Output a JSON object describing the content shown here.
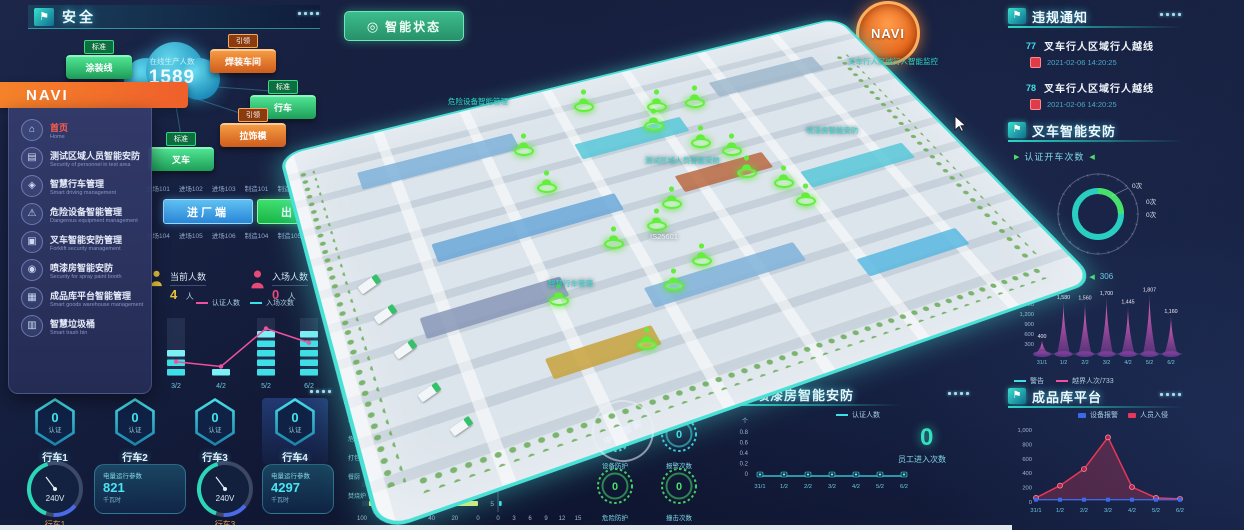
{
  "header": {
    "title": "安全"
  },
  "status_button": {
    "label": "智能状态"
  },
  "navi_badge": {
    "label": "NAVI"
  },
  "menu": {
    "title": "NAVI",
    "items": [
      {
        "label": "首页",
        "sub": "Home",
        "icon": "home-icon",
        "glyph": "⌂",
        "active": true
      },
      {
        "label": "测试区域人员智能安防",
        "sub": "Security of personnel in test area",
        "icon": "test-area-icon",
        "glyph": "▤",
        "active": false
      },
      {
        "label": "智慧行车管理",
        "sub": "Smart driving management",
        "icon": "crane-icon",
        "glyph": "◈",
        "active": false
      },
      {
        "label": "危险设备智能管理",
        "sub": "Dangerous equipment management",
        "icon": "warning-icon",
        "glyph": "⚠",
        "active": false
      },
      {
        "label": "叉车智能安防管理",
        "sub": "Forklift security management",
        "icon": "forklift-icon",
        "glyph": "▣",
        "active": false
      },
      {
        "label": "喷漆房智能安防",
        "sub": "Security for spray paint booth",
        "icon": "spray-icon",
        "glyph": "◉",
        "active": false
      },
      {
        "label": "成品库平台智能管理",
        "sub": "Smart goods warehouse management",
        "icon": "warehouse-icon",
        "glyph": "▦",
        "active": false
      },
      {
        "label": "智慧垃圾桶",
        "sub": "Smart trash bin",
        "icon": "trash-icon",
        "glyph": "▥",
        "active": false
      }
    ]
  },
  "stats": {
    "cloud": {
      "label": "在线生产人数",
      "value": "1589"
    },
    "badges": [
      {
        "tag": "标准",
        "label": "涂装线",
        "color": "green"
      },
      {
        "tag": "引领",
        "label": "焊装车间",
        "color": "orange"
      },
      {
        "tag": "标准",
        "label": "行车",
        "color": "green"
      },
      {
        "tag": "引领",
        "label": "拉饰模",
        "color": "orange"
      },
      {
        "tag": "标准",
        "label": "叉车",
        "color": "green"
      }
    ],
    "gates": {
      "row1": [
        "进场101",
        "进场102",
        "进场103",
        "制造101",
        "制造102",
        "制造103"
      ],
      "in_button": "进厂端",
      "out_button": "出厂端",
      "row2": [
        "进场104",
        "进场105",
        "进场106",
        "制造104",
        "制造105",
        "制造106"
      ]
    },
    "current": {
      "label": "当前人数",
      "value": "4",
      "unit": "人"
    },
    "entered": {
      "label": "入场人数",
      "value": "0",
      "unit": "人"
    },
    "entry_legend": [
      "认证人数",
      "入场次数"
    ]
  },
  "map": {
    "watermark": "中科智能",
    "labels": [
      {
        "text": "危险设备智能管理",
        "x": 448,
        "y": 96,
        "white": false
      },
      {
        "text": "叉车行人区域行人智能监控",
        "x": 848,
        "y": 56,
        "white": false
      },
      {
        "text": "喷漆房智能安防",
        "x": 806,
        "y": 125,
        "white": false
      },
      {
        "text": "测试区域人员智能安防",
        "x": 645,
        "y": 155,
        "white": false
      },
      {
        "text": "智慧行车管理",
        "x": 548,
        "y": 278,
        "white": false
      },
      {
        "text": "IS25601",
        "x": 650,
        "y": 232,
        "white": true
      }
    ],
    "markers": [
      [
        523,
        148
      ],
      [
        583,
        104
      ],
      [
        656,
        104
      ],
      [
        694,
        100
      ],
      [
        653,
        123
      ],
      [
        700,
        140
      ],
      [
        731,
        148
      ],
      [
        746,
        170
      ],
      [
        546,
        185
      ],
      [
        671,
        201
      ],
      [
        656,
        223
      ],
      [
        613,
        241
      ],
      [
        783,
        180
      ],
      [
        805,
        198
      ],
      [
        701,
        258
      ],
      [
        673,
        283
      ],
      [
        646,
        342
      ],
      [
        558,
        298
      ]
    ]
  },
  "notices": {
    "title": "违规通知",
    "items": [
      {
        "id": "77",
        "text": "叉车行人区域行人越线",
        "time": "2021-02-06 14:20:25"
      },
      {
        "id": "78",
        "text": "叉车行人区域行人越线",
        "time": "2021-02-06 14:20:25"
      }
    ]
  },
  "forklift": {
    "title": "叉车智能安防",
    "stat_label": "认证开车次数",
    "donut_labels": [
      "0次",
      "0次",
      "0次"
    ],
    "violation_label": "违规越界次数",
    "violation_value": "306",
    "violation_legend": [
      "警告",
      "越界人次/733"
    ]
  },
  "warehouse": {
    "title": "成品库平台",
    "legend": [
      "设备报警",
      "人员入侵"
    ]
  },
  "trash": {
    "title": "智慧垃圾桶",
    "legend": "余量"
  },
  "device": {
    "title": "点车设备",
    "stats": [
      {
        "label": "设备防护",
        "value": "0",
        "color": "#3ee0e8"
      },
      {
        "label": "报警次数",
        "value": "0",
        "color": "#3ee0e8"
      },
      {
        "label": "危险防护",
        "value": "0",
        "color": "#49e06a"
      },
      {
        "label": "撞击次数",
        "value": "0",
        "color": "#49e06a"
      }
    ]
  },
  "paint": {
    "title": "喷漆房智能安防",
    "legend": "认证人数",
    "unit": "个",
    "big_value": "0",
    "big_label": "员工进入次数"
  },
  "cranes": {
    "items": [
      {
        "name": "行车1",
        "value": "0",
        "cert": "认证"
      },
      {
        "name": "行车2",
        "value": "0",
        "cert": "认证"
      },
      {
        "name": "行车3",
        "value": "0",
        "cert": "认证"
      },
      {
        "name": "行车4",
        "value": "0",
        "cert": "认证"
      }
    ],
    "gauges": [
      {
        "name": "行车1",
        "voltage": "240V",
        "param_title": "电量运行参数",
        "value": "821",
        "unit": "千瓦时"
      },
      {
        "name": "行车3",
        "voltage": "240V",
        "param_title": "电量运行参数",
        "value": "4297",
        "unit": "千瓦时"
      }
    ]
  },
  "chart_data": [
    {
      "id": "entry_stats",
      "type": "bar",
      "categories": [
        "3/2",
        "4/2",
        "5/2",
        "6/2"
      ],
      "series": [
        {
          "name": "入场次数",
          "values": [
            3,
            1,
            5,
            5
          ]
        }
      ],
      "line_series": [
        {
          "name": "认证人数",
          "values": [
            1.5,
            1,
            5,
            3.5
          ]
        }
      ],
      "ylim": [
        0,
        6
      ],
      "legend": [
        "认证人数",
        "入场次数"
      ],
      "legend_position": "top"
    },
    {
      "id": "trash_left",
      "type": "bar",
      "orientation": "horizontal",
      "reversed_axis": true,
      "categories": [
        "未知垃圾",
        "危险垃圾",
        "打包垃圾",
        "餐厨",
        "焚烧炉"
      ],
      "values": [
        96,
        95,
        90,
        95,
        94
      ],
      "xticks": [
        100,
        80,
        60,
        40,
        20,
        0
      ],
      "legend": [
        "余量"
      ]
    },
    {
      "id": "trash_right",
      "type": "bar",
      "orientation": "horizontal",
      "categories": [
        "1",
        "2",
        "3",
        "4",
        "5"
      ],
      "values": [
        14,
        12,
        6,
        0.5,
        0.5
      ],
      "xticks": [
        0,
        3,
        6,
        9,
        12,
        15
      ]
    },
    {
      "id": "paint_line",
      "type": "line",
      "categories": [
        "31/1",
        "1/2",
        "2/2",
        "3/2",
        "4/2",
        "5/2",
        "6/2"
      ],
      "values": [
        0,
        0,
        0,
        0,
        0,
        0,
        0
      ],
      "yticks": [
        0.8,
        0.6,
        0.4,
        0.2,
        0
      ],
      "ylabel": "个",
      "legend": [
        "认证人数"
      ]
    },
    {
      "id": "violation_peaks",
      "type": "area",
      "title": "违规越界次数",
      "categories": [
        "31/1",
        "1/2",
        "2/2",
        "3/2",
        "4/2",
        "5/2",
        "6/2"
      ],
      "values": [
        400,
        1580,
        1560,
        1700,
        1445,
        1807,
        1160
      ],
      "value_labels": [
        "400",
        "1,580",
        "1,560",
        "1,700",
        "1,445",
        "1,807",
        "1,160"
      ],
      "yticks": [
        "1,800",
        "1,500",
        "1,200",
        "900",
        "600",
        "300"
      ],
      "ylim": [
        0,
        1800
      ]
    },
    {
      "id": "forklift_donut",
      "type": "pie",
      "title": "认证开车次数",
      "labels": [
        "0次",
        "0次",
        "0次"
      ],
      "values": [
        0,
        0,
        0
      ]
    },
    {
      "id": "warehouse_line",
      "type": "line",
      "categories": [
        "31/1",
        "1/2",
        "2/2",
        "3/2",
        "4/2",
        "5/2",
        "6/2"
      ],
      "series": [
        {
          "name": "设备报警",
          "values": [
            4,
            4,
            4,
            4,
            4,
            4,
            4
          ],
          "color": "#3b6ae8"
        },
        {
          "name": "人员入侵",
          "values": [
            30,
            200,
            430,
            870,
            180,
            30,
            15
          ],
          "color": "#e8365a"
        }
      ],
      "yticks": [
        "1,000",
        "800",
        "600",
        "400",
        "200",
        "0"
      ],
      "ylim": [
        0,
        1000
      ]
    }
  ]
}
